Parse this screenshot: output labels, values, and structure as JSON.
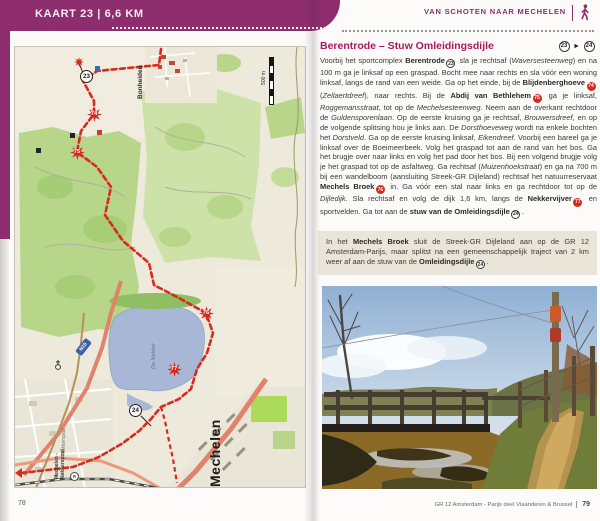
{
  "left_page": {
    "tab_title": "KAART 23 | 6,6 KM",
    "page_number": "78",
    "map": {
      "labels": {
        "bonheiden": "Bonheiden",
        "mechelen": "Mechelen",
        "station_line1": "Mechelen -",
        "station_line2": "Nekkerspoel",
        "station_letter": "R",
        "nekkerspad": "Nekkerspad",
        "lake": "De Nekker",
        "road_shield": "N15",
        "scale": "500 m"
      },
      "markers": {
        "m23": "23",
        "m24": "24",
        "poi1": "74",
        "poi2": "75",
        "poi3": "76",
        "poi4": "77"
      }
    }
  },
  "right_page": {
    "header": "VAN SCHOTEN NAAR MECHELEN",
    "section": {
      "title": "Berentrode – Stuw Omleidingsdijle",
      "route_from": "23",
      "route_to": "24",
      "route_arrow": "►"
    },
    "body_segments": [
      {
        "t": "Voorbij het sportcomplex "
      },
      {
        "t": "Berentrode",
        "s": "b"
      },
      {
        "t": "23",
        "s": "circ"
      },
      {
        "t": " sla je rechtsaf ("
      },
      {
        "t": "Waversesteenweg",
        "s": "i"
      },
      {
        "t": ") en na 100 m ga je linksaf op een graspad. Bocht mee naar rechts en sla vóór een woning linksaf, langs de rand van een weide. Ga op het einde, bij de "
      },
      {
        "t": "Blijdenberghoeve",
        "s": "b"
      },
      {
        "t": "74",
        "s": "badge"
      },
      {
        "t": " ("
      },
      {
        "t": "Zellaertdreef",
        "s": "i"
      },
      {
        "t": "), naar rechts. Bij de "
      },
      {
        "t": "Abdij van Bethlehem",
        "s": "b"
      },
      {
        "t": "75",
        "s": "badge"
      },
      {
        "t": " ga je linksaf, "
      },
      {
        "t": "Roggemansstraat",
        "s": "i"
      },
      {
        "t": ", tot op de "
      },
      {
        "t": "Mechelsesteenweg",
        "s": "i"
      },
      {
        "t": ". Neem aan de overkant rechtdoor de "
      },
      {
        "t": "Guldensporenlaan",
        "s": "i"
      },
      {
        "t": ". Op de eerste kruising ga je rechtsaf, "
      },
      {
        "t": "Brouwersdreef",
        "s": "i"
      },
      {
        "t": ", en op de volgende splitsing hou je links aan. De "
      },
      {
        "t": "Dorsthoeveweg",
        "s": "i"
      },
      {
        "t": " wordt na enkele bochten het "
      },
      {
        "t": "Dorstveld",
        "s": "i"
      },
      {
        "t": ". Ga op de eerste kruising linksaf, "
      },
      {
        "t": "Eikendreef",
        "s": "i"
      },
      {
        "t": ". Voorbij een bareel ga je linksaf over de Boeimeerbeek. Volg het graspad tot aan de rand van het bos. Ga het brugje over naar links en volg het pad door het bos. Bij een volgend brugje volg je het graspad tot op de asfaltweg. Ga rechtsaf ("
      },
      {
        "t": "Muizenhoekstraat",
        "s": "i"
      },
      {
        "t": ") en ga na 700 m bij een wandelboom (aansluiting Streek-GR Dijleland) rechtsaf het natuurreservaat "
      },
      {
        "t": "Mechels Broek",
        "s": "b"
      },
      {
        "t": "76",
        "s": "badge"
      },
      {
        "t": " in. Ga vóór een stal naar links en ga rechtdoor tot op de "
      },
      {
        "t": "Dijledijk",
        "s": "i"
      },
      {
        "t": ". Sla rechtsaf en volg de dijk 1,6 km, langs de "
      },
      {
        "t": "Nekkervijver",
        "s": "b"
      },
      {
        "t": "77",
        "s": "badge"
      },
      {
        "t": " en sportvelden. Ga tot aan de "
      },
      {
        "t": "stuw van de Omleidingsdijle",
        "s": "b"
      },
      {
        "t": "24",
        "s": "circ"
      },
      {
        "t": "."
      }
    ],
    "info_segments": [
      {
        "t": "In het "
      },
      {
        "t": "Mechels Broek",
        "s": "b"
      },
      {
        "t": " sluit de Streek-GR Dijleland aan op de GR 12 Amsterdam-Parijs, maar splitst na een gemeenschappelijk traject van 2 km weer af aan de stuw van de "
      },
      {
        "t": "Omleidingsdijle",
        "s": "b"
      },
      {
        "t": "24",
        "s": "circ"
      },
      {
        "t": "."
      }
    ],
    "footer_text": "GR 12 Amsterdam - Parijs  deel Vlaanderen & Brussel",
    "page_number": "79"
  }
}
